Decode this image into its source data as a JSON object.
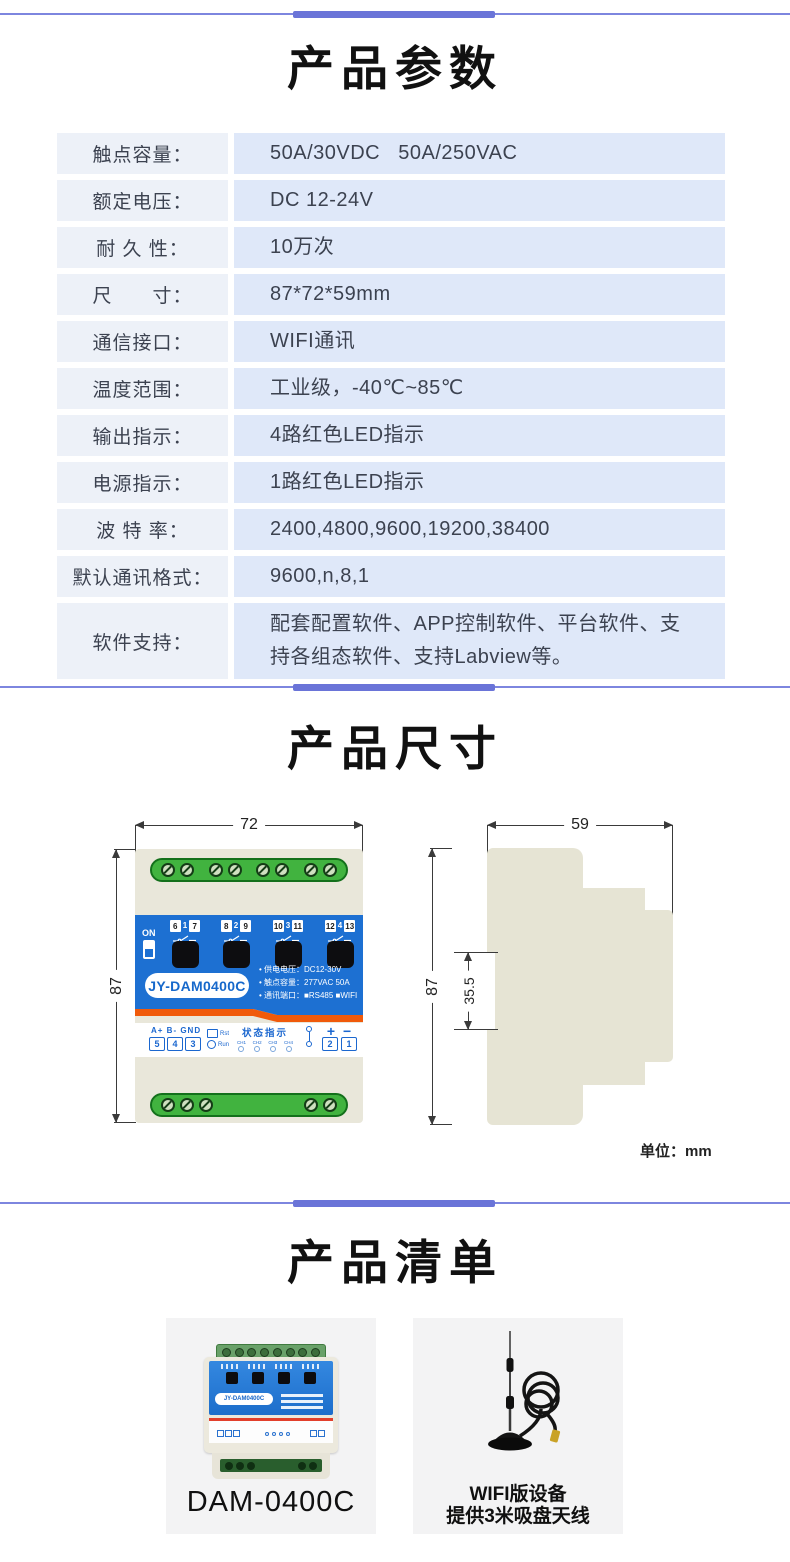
{
  "colors": {
    "divider_bar": "#6a74d8",
    "divider_line": "#7d86df",
    "table_label_bg": "#edf1f8",
    "table_value_bg": "#dfe8f9",
    "table_text": "#3c4250",
    "device_blue": "#1d70d2",
    "device_orange": "#f05a0a",
    "terminal_green": "#41b33f",
    "front_body_beige": "#e9e7da",
    "side_body_beige": "#e6e4d4",
    "card_bg": "#f3f3f4",
    "io_label_blue": "#1b67cf"
  },
  "params": {
    "title": "产品参数",
    "rows": [
      {
        "label": "触点容量：",
        "value": "50A/30VDC   50A/250VAC"
      },
      {
        "label": "额定电压：",
        "value": "DC 12-24V"
      },
      {
        "label": "耐 久 性：",
        "value": "10万次"
      },
      {
        "label": "尺　　寸：",
        "value": "87*72*59mm"
      },
      {
        "label": "通信接口：",
        "value": "WIFI通讯"
      },
      {
        "label": "温度范围：",
        "value": "工业级，-40℃~85℃"
      },
      {
        "label": "输出指示：",
        "value": "4路红色LED指示"
      },
      {
        "label": "电源指示：",
        "value": "1路红色LED指示"
      },
      {
        "label": "波 特 率：",
        "value": "2400,4800,9600,19200,38400"
      },
      {
        "label": "默认通讯格式：",
        "value": "9600,n,8,1"
      },
      {
        "label": "软件支持：",
        "value": "配套配置软件、APP控制软件、平台软件、支持各组态软件、支持Labview等。"
      }
    ]
  },
  "dimensions": {
    "title": "产品尺寸",
    "front_width": "72",
    "front_height": "87",
    "side_width": "59",
    "side_height": "87",
    "side_notch": "35.5",
    "unit_note": "单位：mm"
  },
  "device": {
    "model": "JY-DAM0400C",
    "on_label": "ON",
    "terminal_groups": [
      [
        "6",
        "1",
        "7"
      ],
      [
        "8",
        "2",
        "9"
      ],
      [
        "10",
        "3",
        "11"
      ],
      [
        "12",
        "4",
        "13"
      ]
    ],
    "spec_lines": [
      "• 供电电压：DC12-30V",
      "• 触点容量：277VAC 50A",
      "• 通讯端口：■RS485 ■WIFI"
    ],
    "io_labels": "A+ B- GND",
    "io_pins": [
      "5",
      "4",
      "3"
    ],
    "rst_label": "Rst",
    "run_label": "Run",
    "status_title": "状态指示",
    "channel_labels": [
      "CH1",
      "CH2",
      "CH3",
      "CH4"
    ],
    "plus_label": "+",
    "minus_label": "−",
    "power_pins": [
      "2",
      "1"
    ]
  },
  "product_list": {
    "title": "产品清单",
    "items": [
      {
        "caption": "DAM-0400C"
      },
      {
        "caption_line1": "WIFI版设备",
        "caption_line2": "提供3米吸盘天线"
      }
    ]
  }
}
